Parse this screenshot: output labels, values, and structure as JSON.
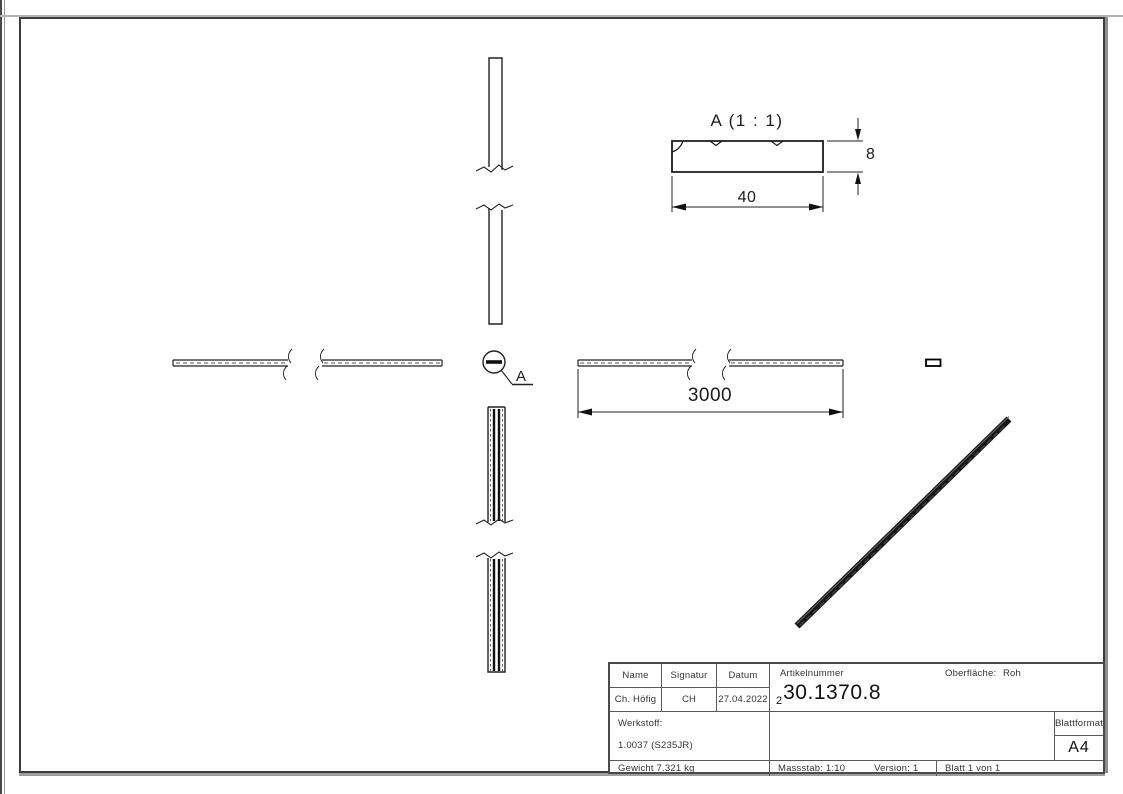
{
  "views": {
    "detail_title": "A (1 : 1)",
    "dim_height": "8",
    "dim_width": "40",
    "dim_length": "3000",
    "detail_label": "A"
  },
  "title_block": {
    "name_label": "Name",
    "signatur_label": "Signatur",
    "datum_label": "Datum",
    "name_value": "Ch. Höfig",
    "signatur_value": "CH",
    "datum_value": "27.04.2022",
    "artikelnummer_label": "Artikelnummer",
    "artikelnummer_prefix": "2",
    "artikelnummer_value": "30.1370.8",
    "oberflaeche_label": "Oberfläche:",
    "oberflaeche_value": "Roh",
    "werkstoff_label": "Werkstoff:",
    "werkstoff_value": "1.0037 (S235JR)",
    "gewicht_value": "Gewicht 7.321 kg",
    "massstab_value": "Massstab: 1:10",
    "version_value": "Version: 1",
    "blatt_value": "Blatt 1 von 1",
    "blattformat_label": "Blattformat",
    "blattformat_value": "A4"
  },
  "colors": {
    "line": "#222222",
    "frame_border": "#3c3c3c",
    "titleblock_grid": "#5a5a5a",
    "iso_bar": "#161616"
  }
}
